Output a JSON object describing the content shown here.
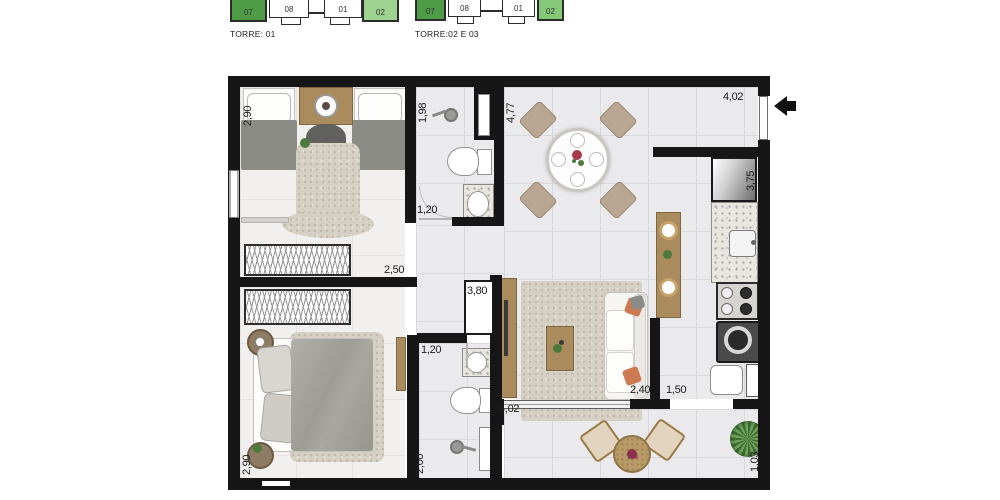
{
  "key_plans": [
    {
      "name": "TORRE: 01",
      "units": [
        "07",
        "08",
        "01",
        "02"
      ]
    },
    {
      "name": "TORRE:02 E 03",
      "units": [
        "07",
        "08",
        "01",
        "02"
      ]
    }
  ],
  "dims": {
    "bedroom1_height": "2,90",
    "bath1_length": "1,98",
    "dining_height": "4,77",
    "top_width": "4,02",
    "kitchen_height": "3,75",
    "bath1_width": "1,20",
    "bedroom2_width": "2,50",
    "hall_length": "3,80",
    "bath2_width": "1,20",
    "sofa_span": "2,40",
    "service_width": "1,50",
    "balcony_width": "4,02",
    "bath2_height": "2,00",
    "bedroom2_height": "2,90",
    "balcony_depth": "1,03"
  },
  "colors": {
    "unit_highlight_dark": "#4f9c46",
    "unit_highlight_light": "#9ed28f",
    "unit_highlight_light2": "#85c878",
    "wall": "#161616",
    "wood": "#a98b5e",
    "floor_tile": "#eaeaec",
    "accent_pillow": "#cd7a52",
    "plant_green": "#4c7a3c"
  },
  "icons": {
    "entrance_arrow": "left-arrow"
  }
}
